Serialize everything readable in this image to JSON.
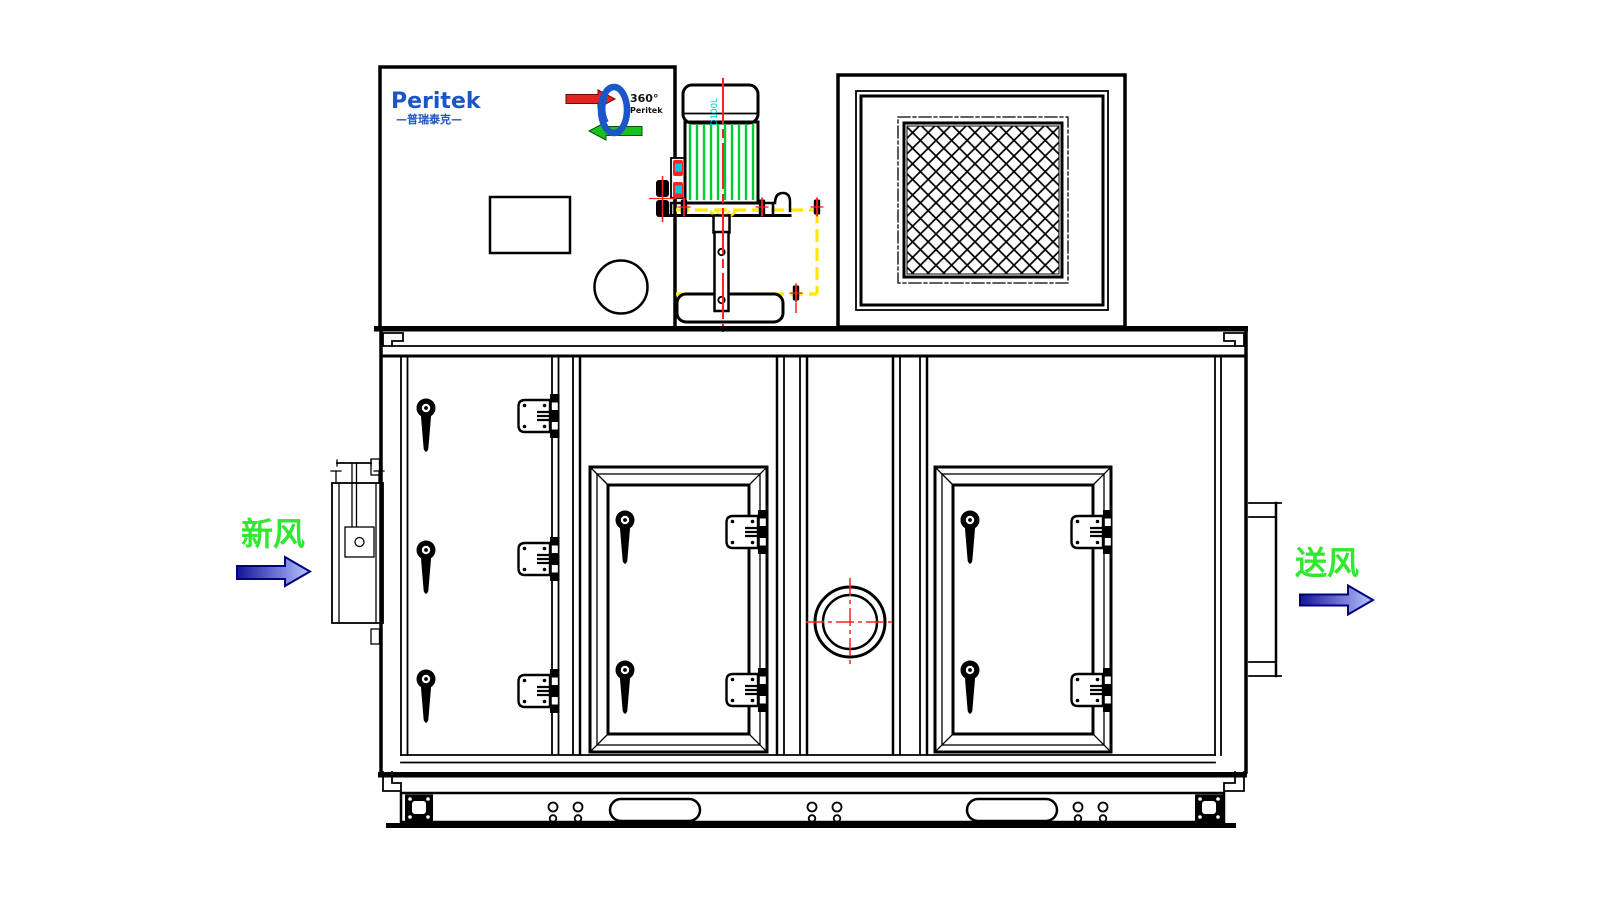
{
  "branding": {
    "logo_text": "Peritek",
    "logo_subtext": "—普瑞泰克—",
    "logo_color": "#1a56c8",
    "rotor_badge": {
      "degrees_text": "360°",
      "brand_text": "Peritek",
      "wheel_color": "#1a56c8",
      "process_arrow_color": "#e32222",
      "reactivation_arrow_color": "#17c21e"
    }
  },
  "motor": {
    "model_label": "D100L",
    "model_label_color": "#00c8dc",
    "fin_color": "#00cc33",
    "fin_count": 10
  },
  "flow_labels": {
    "fresh_air": {
      "text": "新风",
      "color": "#2fe82f",
      "direction": "right"
    },
    "supply_air": {
      "text": "送风",
      "color": "#2fe82f",
      "direction": "right"
    }
  },
  "colors": {
    "line_black": "#000000",
    "background": "#ffffff",
    "brand_blue": "#1a56c8",
    "badge_red": "#e32222",
    "badge_green": "#17c21e",
    "fin_green": "#00cc33",
    "label_green": "#2fe82f",
    "centerline_red": "#ff2020",
    "phantom_yellow": "#ffe800",
    "accent_cyan": "#00c8dc",
    "arrow_outline_navy": "#000080",
    "arrow_dark": "#14149b",
    "arrow_light": "#b8c4ff"
  },
  "components": {
    "top_row": [
      "control box with brand logo, electrical box and pipe port",
      "rotor drive motor on mounting bracket with phantom outline",
      "return air grille with mesh filter"
    ],
    "cabinet_sections": [
      "access panel with 3 handles and 3 latches",
      "inspection door with 2 handles and 2 latches",
      "round sight glass port with centerline cross",
      "inspection door with 2 handles and 2 latches"
    ],
    "side_fittings": [
      "fresh air damper box with actuator",
      "supply air outlet flange"
    ],
    "base": {
      "lifting_slots": 2,
      "bolt_hole_pairs": 6,
      "end_brackets": 2
    }
  }
}
